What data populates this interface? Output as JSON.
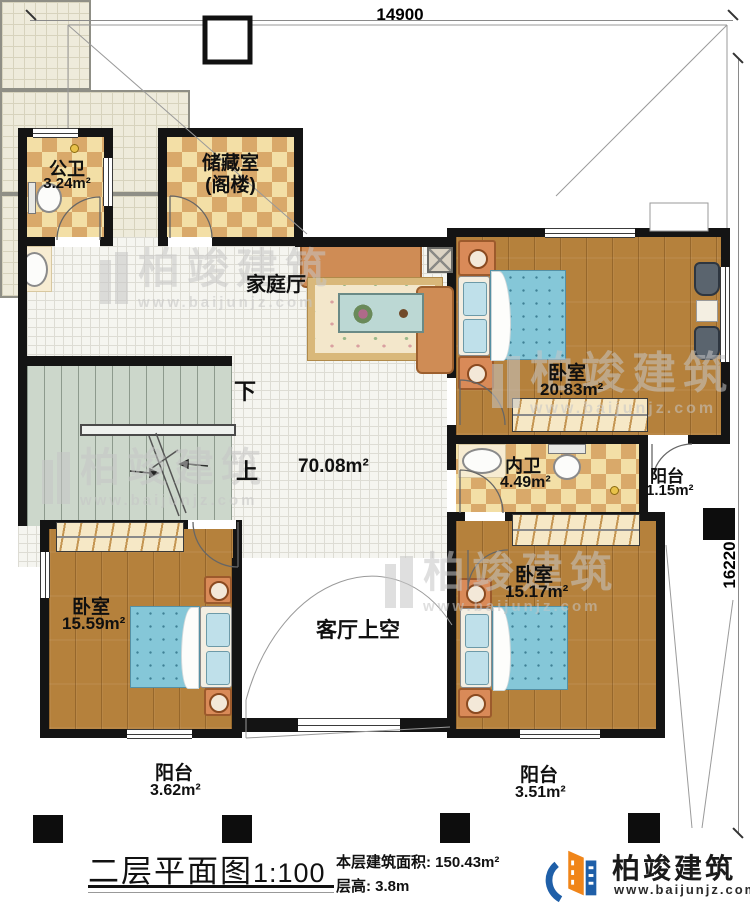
{
  "plan": {
    "dim_width": "14900",
    "dim_height": "16220",
    "rooms": {
      "public_bath": {
        "name": "公卫",
        "area": "3.24m²"
      },
      "storage": {
        "line1": "储藏室",
        "line2": "(阁楼)"
      },
      "family_hall": {
        "name": "家庭厅",
        "area": "70.08m²"
      },
      "bedroom_master": {
        "name": "卧室",
        "area": "20.83m²"
      },
      "inner_bath": {
        "name": "内卫",
        "area": "4.49m²"
      },
      "balcony_east": {
        "name": "阳台",
        "area": "1.15m²"
      },
      "bedroom_west": {
        "name": "卧室",
        "area": "15.59m²"
      },
      "bedroom_south": {
        "name": "卧室",
        "area": "15.17m²"
      },
      "living_void": {
        "name": "客厅上空"
      },
      "balcony_sw": {
        "name": "阳台",
        "area": "3.62m²"
      },
      "balcony_se": {
        "name": "阳台",
        "area": "3.51m²"
      }
    },
    "stairs": {
      "down": "下",
      "up": "上"
    }
  },
  "footer": {
    "title": "二层平面图",
    "scale": "1:100",
    "area_label": "本层建筑面积:",
    "area_value": "150.43m²",
    "height_label": "层高:",
    "height_value": "3.8m"
  },
  "brand": {
    "name": "柏竣建筑",
    "site": "www.baijunjz.com"
  },
  "watermark": {
    "name": "柏竣建筑",
    "site": "www.baijunjz.com"
  },
  "colors": {
    "wall": "#141414",
    "logo_blue": "#1f5fa8",
    "logo_orange": "#f08519",
    "bed_blue": "#85c7d8"
  }
}
